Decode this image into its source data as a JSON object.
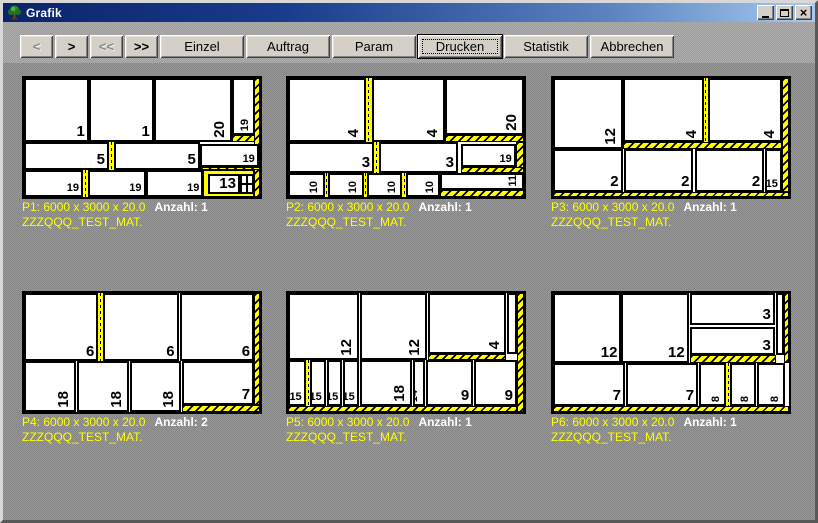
{
  "window": {
    "title": "Grafik"
  },
  "titlebar": {
    "icon": "tree-icon",
    "buttons": [
      {
        "name": "minimize-button",
        "glyph": "minimize"
      },
      {
        "name": "maximize-button",
        "glyph": "maximize"
      },
      {
        "name": "close-button",
        "glyph": "close"
      }
    ]
  },
  "colors": {
    "waste_yellow": "#ffff00",
    "piece_white": "#ffffff",
    "label_yellow": "#ffff00",
    "anzahl_white": "#ffffff",
    "titlebar_from": "#0a246a",
    "titlebar_to": "#a6caf0",
    "button_face": "#d4d0c8"
  },
  "toolbar": {
    "buttons": [
      {
        "label": "<",
        "name": "prev-button",
        "narrow": true,
        "disabled": true
      },
      {
        "label": ">",
        "name": "next-button",
        "narrow": true
      },
      {
        "label": "<<",
        "name": "first-button",
        "narrow": true,
        "disabled": true
      },
      {
        "label": ">>",
        "name": "last-button",
        "narrow": true
      },
      {
        "label": "Einzel",
        "name": "einzel-button"
      },
      {
        "label": "Auftrag",
        "name": "auftrag-button"
      },
      {
        "label": "Param",
        "name": "param-button"
      },
      {
        "label": "Drucken",
        "name": "drucken-button",
        "focused": true
      },
      {
        "label": "Statistik",
        "name": "statistik-button"
      },
      {
        "label": "Abbrechen",
        "name": "abbrechen-button"
      }
    ]
  },
  "panels": [
    {
      "id": "P1",
      "info": "P1: 6000 x 3000 x 20.0",
      "anzahl": "Anzahl: 1",
      "material": "ZZZQQQ_TEST_MAT.",
      "wastes": [
        {
          "x": 97.5,
          "y": 0,
          "w": 2.5,
          "h": 100,
          "k": "hatch"
        },
        {
          "x": 88,
          "y": 48,
          "w": 10,
          "h": 5.5,
          "k": "hatch"
        },
        {
          "x": 36,
          "y": 53.5,
          "w": 2,
          "h": 24,
          "k": "dash"
        },
        {
          "x": 74.5,
          "y": 75,
          "w": 25.5,
          "h": 2.5,
          "k": "hatch"
        },
        {
          "x": 25,
          "y": 77.5,
          "w": 2,
          "h": 22.5,
          "k": "dash"
        },
        {
          "x": 76,
          "y": 77.5,
          "w": 21.5,
          "h": 22.5,
          "k": "solid"
        }
      ],
      "pieces": [
        {
          "x": 0,
          "y": 0,
          "w": 27.5,
          "h": 53.5,
          "t": "1"
        },
        {
          "x": 27.5,
          "y": 0,
          "w": 27.5,
          "h": 53.5,
          "t": "1"
        },
        {
          "x": 55,
          "y": 0,
          "w": 33,
          "h": 53.5,
          "t": "20",
          "r": true
        },
        {
          "x": 88,
          "y": 0,
          "w": 10,
          "h": 48,
          "t": "19",
          "r": true,
          "s": true
        },
        {
          "x": 0,
          "y": 53.5,
          "w": 36,
          "h": 24,
          "t": "5"
        },
        {
          "x": 38,
          "y": 53.5,
          "w": 36.5,
          "h": 24,
          "t": "5"
        },
        {
          "x": 74.5,
          "y": 55.5,
          "w": 25,
          "h": 19.5,
          "t": "19",
          "s": true
        },
        {
          "x": 0,
          "y": 77.5,
          "w": 25,
          "h": 22.5,
          "t": "19",
          "s": true
        },
        {
          "x": 27,
          "y": 77.5,
          "w": 24.5,
          "h": 22.5,
          "t": "19",
          "s": true
        },
        {
          "x": 51.5,
          "y": 77.5,
          "w": 24.5,
          "h": 22.5,
          "t": "19",
          "s": true
        },
        {
          "x": 78,
          "y": 80.5,
          "w": 13.5,
          "h": 17,
          "t": "13"
        },
        {
          "x": 91.5,
          "y": 80.5,
          "w": 6,
          "h": 17,
          "t": "",
          "cross": true
        }
      ]
    },
    {
      "id": "P2",
      "info": "P2: 6000 x 3000 x 20.0",
      "anzahl": "Anzahl: 1",
      "material": "ZZZQQQ_TEST_MAT.",
      "wastes": [
        {
          "x": 33,
          "y": 0,
          "w": 2.5,
          "h": 53.5,
          "k": "dash"
        },
        {
          "x": 66.5,
          "y": 48,
          "w": 33.5,
          "h": 5.5,
          "k": "hatch"
        },
        {
          "x": 36.5,
          "y": 53.5,
          "w": 2,
          "h": 26,
          "k": "dash"
        },
        {
          "x": 96.5,
          "y": 53.5,
          "w": 3.5,
          "h": 26,
          "k": "hatch"
        },
        {
          "x": 73.5,
          "y": 75,
          "w": 26.5,
          "h": 4.5,
          "k": "hatch"
        },
        {
          "x": 15.5,
          "y": 79.5,
          "w": 1.5,
          "h": 20.5,
          "k": "dash"
        },
        {
          "x": 32,
          "y": 79.5,
          "w": 1.5,
          "h": 20.5,
          "k": "dash"
        },
        {
          "x": 48.5,
          "y": 79.5,
          "w": 1.5,
          "h": 20.5,
          "k": "dash"
        },
        {
          "x": 64.5,
          "y": 94.5,
          "w": 35.5,
          "h": 5.5,
          "k": "hatch"
        }
      ],
      "pieces": [
        {
          "x": 0,
          "y": 0,
          "w": 33,
          "h": 53.5,
          "t": "4",
          "r": true
        },
        {
          "x": 35.5,
          "y": 0,
          "w": 31,
          "h": 53.5,
          "t": "4",
          "r": true
        },
        {
          "x": 66.5,
          "y": 0,
          "w": 33.5,
          "h": 48,
          "t": "20",
          "r": true
        },
        {
          "x": 0,
          "y": 53.5,
          "w": 36.5,
          "h": 26,
          "t": "3"
        },
        {
          "x": 38.5,
          "y": 53.5,
          "w": 33.5,
          "h": 26,
          "t": "3"
        },
        {
          "x": 73.5,
          "y": 55.5,
          "w": 23,
          "h": 19.5,
          "t": "19",
          "s": true
        },
        {
          "x": 0,
          "y": 79.5,
          "w": 15.5,
          "h": 20.5,
          "t": "10",
          "r": true,
          "s": true
        },
        {
          "x": 17,
          "y": 79.5,
          "w": 15,
          "h": 20.5,
          "t": "10",
          "r": true,
          "s": true
        },
        {
          "x": 33.5,
          "y": 79.5,
          "w": 15,
          "h": 20.5,
          "t": "10",
          "r": true,
          "s": true
        },
        {
          "x": 50,
          "y": 79.5,
          "w": 14.5,
          "h": 20.5,
          "t": "10",
          "r": true,
          "s": true
        },
        {
          "x": 64.5,
          "y": 79.5,
          "w": 35.5,
          "h": 15,
          "t": "11",
          "r": true,
          "s": true
        }
      ]
    },
    {
      "id": "P3",
      "info": "P3: 6000 x 3000 x 20.0",
      "anzahl": "Anzahl: 1",
      "material": "ZZZQQQ_TEST_MAT.",
      "wastes": [
        {
          "x": 97,
          "y": 0,
          "w": 3,
          "h": 96,
          "k": "hatch"
        },
        {
          "x": 64,
          "y": 0,
          "w": 1.5,
          "h": 54,
          "k": "dash"
        },
        {
          "x": 29.5,
          "y": 54,
          "w": 67.5,
          "h": 5.5,
          "k": "hatch"
        },
        {
          "x": 0,
          "y": 96,
          "w": 100,
          "h": 4,
          "k": "hatch"
        }
      ],
      "pieces": [
        {
          "x": 0,
          "y": 0,
          "w": 29.5,
          "h": 59.5,
          "t": "12",
          "r": true
        },
        {
          "x": 29.5,
          "y": 0,
          "w": 34.5,
          "h": 54,
          "t": "4",
          "r": true
        },
        {
          "x": 65.5,
          "y": 0,
          "w": 31.5,
          "h": 54,
          "t": "4",
          "r": true
        },
        {
          "x": 0,
          "y": 59.5,
          "w": 29.5,
          "h": 36.5,
          "t": "2"
        },
        {
          "x": 30,
          "y": 59.5,
          "w": 29.5,
          "h": 36.5,
          "t": "2"
        },
        {
          "x": 60,
          "y": 59.5,
          "w": 29.5,
          "h": 36.5,
          "t": "2"
        },
        {
          "x": 90,
          "y": 59.5,
          "w": 7,
          "h": 36.5,
          "t": "15",
          "s": true
        }
      ]
    },
    {
      "id": "P4",
      "info": "P4: 6000 x 3000 x 20.0",
      "anzahl": "Anzahl: 2",
      "material": "ZZZQQQ_TEST_MAT.",
      "wastes": [
        {
          "x": 31.5,
          "y": 0,
          "w": 2,
          "h": 57.5,
          "k": "dash"
        },
        {
          "x": 97.5,
          "y": 0,
          "w": 2.5,
          "h": 94,
          "k": "hatch"
        },
        {
          "x": 67,
          "y": 94,
          "w": 33,
          "h": 6,
          "k": "hatch"
        }
      ],
      "pieces": [
        {
          "x": 0,
          "y": 0,
          "w": 31.5,
          "h": 57.5,
          "t": "6"
        },
        {
          "x": 33.5,
          "y": 0,
          "w": 32,
          "h": 57.5,
          "t": "6"
        },
        {
          "x": 66,
          "y": 0,
          "w": 31.5,
          "h": 57.5,
          "t": "6"
        },
        {
          "x": 0,
          "y": 57.5,
          "w": 22,
          "h": 42.5,
          "t": "18",
          "r": true
        },
        {
          "x": 22.5,
          "y": 57.5,
          "w": 22,
          "h": 42.5,
          "t": "18",
          "r": true
        },
        {
          "x": 45,
          "y": 57.5,
          "w": 21.5,
          "h": 42.5,
          "t": "18",
          "r": true
        },
        {
          "x": 67,
          "y": 57.5,
          "w": 30.5,
          "h": 36.5,
          "t": "7"
        }
      ]
    },
    {
      "id": "P5",
      "info": "P5: 6000 x 3000 x 20.0",
      "anzahl": "Anzahl: 1",
      "material": "ZZZQQQ_TEST_MAT.",
      "wastes": [
        {
          "x": 97,
          "y": 0,
          "w": 3,
          "h": 100,
          "k": "hatch"
        },
        {
          "x": 59.5,
          "y": 51,
          "w": 33,
          "h": 5,
          "k": "hatch"
        },
        {
          "x": 7.5,
          "y": 56,
          "w": 2,
          "h": 39,
          "k": "dash"
        },
        {
          "x": 0,
          "y": 95,
          "w": 97,
          "h": 5,
          "k": "hatch"
        }
      ],
      "pieces": [
        {
          "x": 0,
          "y": 0,
          "w": 30,
          "h": 56,
          "t": "12",
          "r": true
        },
        {
          "x": 30.5,
          "y": 0,
          "w": 28.5,
          "h": 56,
          "t": "12",
          "r": true
        },
        {
          "x": 59.5,
          "y": 0,
          "w": 33,
          "h": 51,
          "t": "4",
          "r": true
        },
        {
          "x": 93,
          "y": 0,
          "w": 4,
          "h": 51,
          "t": ""
        },
        {
          "x": 0,
          "y": 56,
          "w": 7.5,
          "h": 39,
          "t": "15",
          "s": true
        },
        {
          "x": 9.5,
          "y": 56,
          "w": 6.5,
          "h": 39,
          "t": "15",
          "s": true
        },
        {
          "x": 16.5,
          "y": 56,
          "w": 6.5,
          "h": 39,
          "t": "15",
          "s": true
        },
        {
          "x": 23.5,
          "y": 56,
          "w": 6.5,
          "h": 39,
          "t": "15",
          "s": true
        },
        {
          "x": 30.5,
          "y": 56,
          "w": 22,
          "h": 39,
          "t": "18",
          "r": true
        },
        {
          "x": 53,
          "y": 56,
          "w": 5,
          "h": 39,
          "t": "14",
          "r": true,
          "s": true
        },
        {
          "x": 58.5,
          "y": 56,
          "w": 20,
          "h": 39,
          "t": "9"
        },
        {
          "x": 79,
          "y": 56,
          "w": 18,
          "h": 39,
          "t": "9"
        }
      ]
    },
    {
      "id": "P6",
      "info": "P6: 6000 x 3000 x 20.0",
      "anzahl": "Anzahl: 1",
      "material": "ZZZQQQ_TEST_MAT.",
      "wastes": [
        {
          "x": 98,
          "y": 0,
          "w": 2,
          "h": 59,
          "k": "hatch"
        },
        {
          "x": 58,
          "y": 52.5,
          "w": 36.5,
          "h": 6.5,
          "k": "hatch"
        },
        {
          "x": 73.5,
          "y": 59,
          "w": 1.5,
          "h": 36,
          "k": "dash"
        },
        {
          "x": 0,
          "y": 95,
          "w": 100,
          "h": 5,
          "k": "hatch"
        }
      ],
      "pieces": [
        {
          "x": 0,
          "y": 0,
          "w": 29,
          "h": 59,
          "t": "12"
        },
        {
          "x": 29,
          "y": 0,
          "w": 28.5,
          "h": 59,
          "t": "12"
        },
        {
          "x": 58,
          "y": 0,
          "w": 36,
          "h": 27,
          "t": "3"
        },
        {
          "x": 58,
          "y": 28.5,
          "w": 36,
          "h": 24,
          "t": "3"
        },
        {
          "x": 94.5,
          "y": 0,
          "w": 3.5,
          "h": 52.5,
          "t": ""
        },
        {
          "x": 0,
          "y": 59,
          "w": 30.5,
          "h": 36,
          "t": "7"
        },
        {
          "x": 31,
          "y": 59,
          "w": 30.5,
          "h": 36,
          "t": "7"
        },
        {
          "x": 62,
          "y": 59,
          "w": 11.5,
          "h": 36,
          "t": "8",
          "r": true,
          "s": true
        },
        {
          "x": 75,
          "y": 59,
          "w": 11,
          "h": 36,
          "t": "8",
          "r": true,
          "s": true
        },
        {
          "x": 86.5,
          "y": 59,
          "w": 12,
          "h": 36,
          "t": "8",
          "r": true,
          "s": true
        }
      ]
    }
  ]
}
